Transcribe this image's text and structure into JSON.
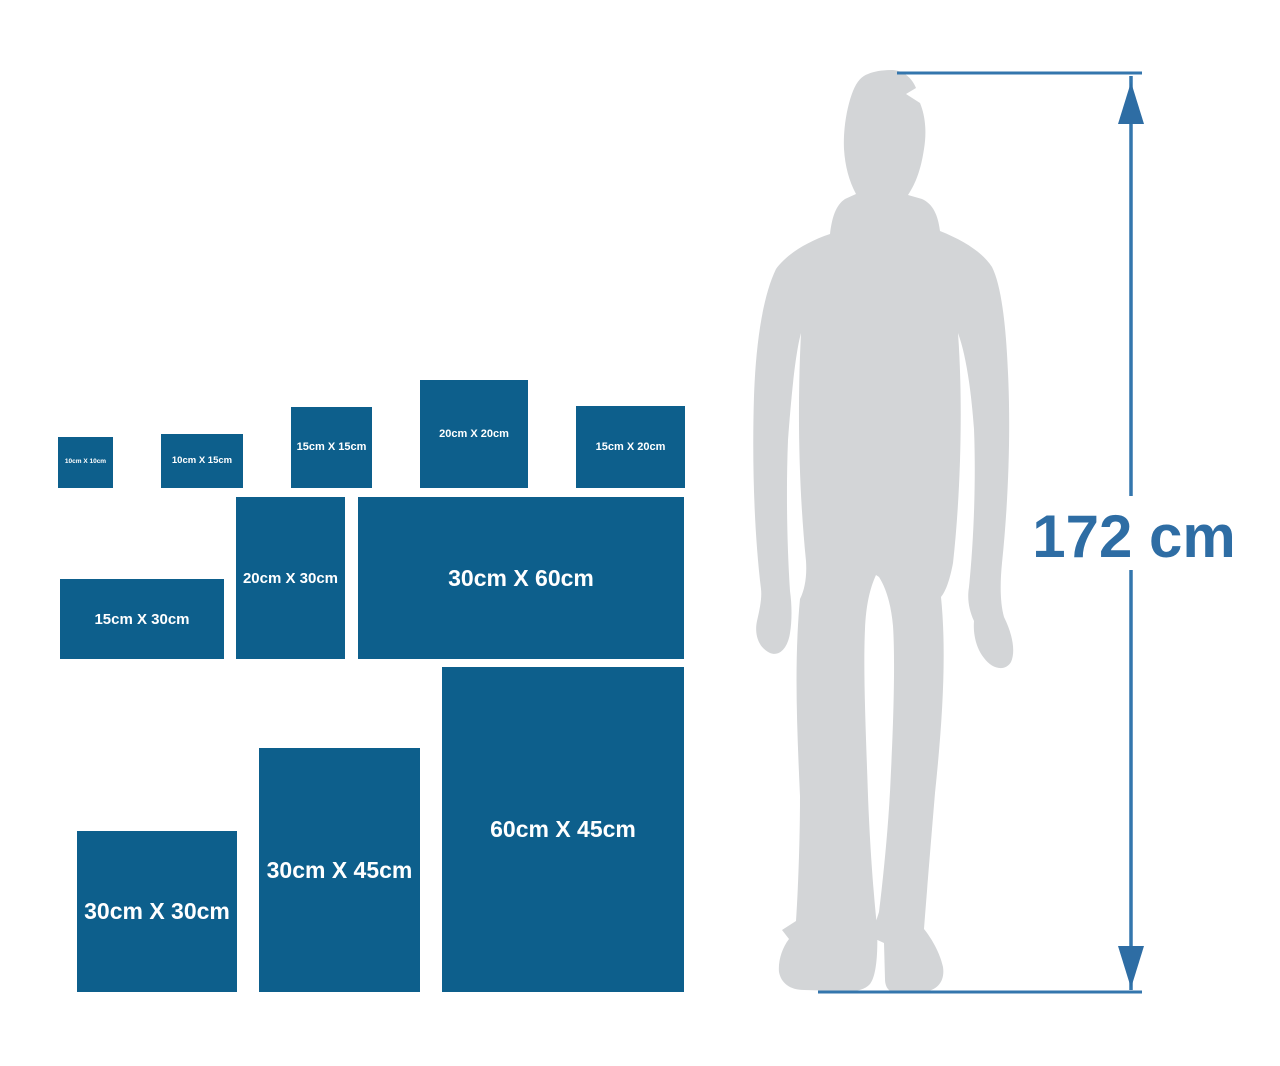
{
  "colors": {
    "box_fill": "#0d5f8c",
    "box_label": "#ffffff",
    "silhouette": "#d3d5d7",
    "measure": "#2e6da4",
    "line": "#3476ad",
    "background": "#ffffff"
  },
  "sizes": [
    {
      "label": "10cm X 10cm",
      "width_cm": 10,
      "height_cm": 10
    },
    {
      "label": "10cm X 15cm",
      "width_cm": 15,
      "height_cm": 10
    },
    {
      "label": "15cm X 15cm",
      "width_cm": 15,
      "height_cm": 15
    },
    {
      "label": "20cm X 20cm",
      "width_cm": 20,
      "height_cm": 20
    },
    {
      "label": "15cm X 20cm",
      "width_cm": 20,
      "height_cm": 15
    },
    {
      "label": "20cm X 30cm",
      "width_cm": 20,
      "height_cm": 30
    },
    {
      "label": "30cm X 60cm",
      "width_cm": 60,
      "height_cm": 30
    },
    {
      "label": "15cm X 30cm",
      "width_cm": 30,
      "height_cm": 15
    },
    {
      "label": "30cm X 30cm",
      "width_cm": 30,
      "height_cm": 30
    },
    {
      "label": "30cm X 45cm",
      "width_cm": 30,
      "height_cm": 45
    },
    {
      "label": "60cm X 45cm",
      "width_cm": 45,
      "height_cm": 60
    }
  ],
  "figure": {
    "height_label": "172 cm"
  }
}
